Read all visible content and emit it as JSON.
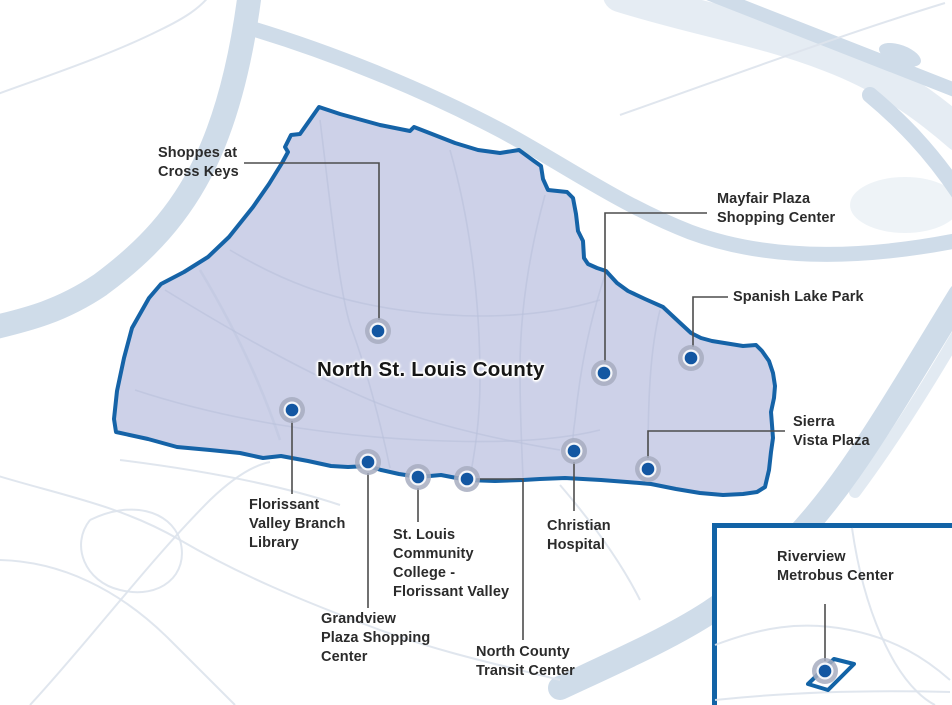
{
  "title": "North St. Louis County",
  "colors": {
    "region_fill": "#cdd1e8",
    "region_border": "#1563a7",
    "marker_dot": "#1357a2",
    "marker_halo": "#f4f6fa",
    "marker_ring": "#a7adc0",
    "leader_line": "#4d4d4d",
    "inset_border": "#1263a6",
    "river": "#cfdce9",
    "road": "#dde3ec",
    "label_text": "#2b2b2b"
  },
  "locations": [
    {
      "id": "shoppes-at-cross-keys",
      "lines": [
        "Shoppes at",
        "Cross Keys"
      ],
      "marker": {
        "x": 378,
        "y": 331
      },
      "leader": [
        [
          244,
          163
        ],
        [
          379,
          163
        ],
        [
          379,
          320
        ]
      ],
      "label": {
        "x": 158,
        "y": 144
      }
    },
    {
      "id": "mayfair-plaza-shopping-center",
      "lines": [
        "Mayfair Plaza",
        "Shopping Center"
      ],
      "marker": {
        "x": 604,
        "y": 373
      },
      "leader": [
        [
          707,
          213
        ],
        [
          605,
          213
        ],
        [
          605,
          362
        ]
      ],
      "label": {
        "x": 717,
        "y": 190
      }
    },
    {
      "id": "spanish-lake-park",
      "lines": [
        "Spanish Lake Park"
      ],
      "marker": {
        "x": 691,
        "y": 358
      },
      "leader": [
        [
          728,
          297
        ],
        [
          693,
          297
        ],
        [
          693,
          347
        ]
      ],
      "label": {
        "x": 733,
        "y": 288
      }
    },
    {
      "id": "sierra-vista-plaza",
      "lines": [
        "Sierra",
        "Vista Plaza"
      ],
      "marker": {
        "x": 648,
        "y": 469
      },
      "leader": [
        [
          785,
          431
        ],
        [
          648,
          431
        ],
        [
          648,
          458
        ]
      ],
      "label": {
        "x": 793,
        "y": 413
      }
    },
    {
      "id": "florissant-valley-branch-library",
      "lines": [
        "Florissant",
        "Valley Branch",
        "Library"
      ],
      "marker": {
        "x": 292,
        "y": 410
      },
      "leader": [
        [
          292,
          421
        ],
        [
          292,
          494
        ]
      ],
      "label": {
        "x": 249,
        "y": 496
      }
    },
    {
      "id": "st-louis-community-college-florissant-valley",
      "lines": [
        "St. Louis",
        "Community",
        "College -",
        "Florissant Valley"
      ],
      "marker": {
        "x": 418,
        "y": 477
      },
      "leader": [
        [
          418,
          488
        ],
        [
          418,
          522
        ]
      ],
      "label": {
        "x": 393,
        "y": 526
      }
    },
    {
      "id": "grandview-plaza-shopping-center",
      "lines": [
        "Grandview",
        "Plaza Shopping",
        "Center"
      ],
      "marker": {
        "x": 368,
        "y": 462
      },
      "leader": [
        [
          368,
          473
        ],
        [
          368,
          608
        ]
      ],
      "label": {
        "x": 321,
        "y": 610
      }
    },
    {
      "id": "christian-hospital",
      "lines": [
        "Christian",
        "Hospital"
      ],
      "marker": {
        "x": 574,
        "y": 451
      },
      "leader": [
        [
          574,
          462
        ],
        [
          574,
          511
        ]
      ],
      "label": {
        "x": 547,
        "y": 517
      }
    },
    {
      "id": "north-county-transit-center",
      "lines": [
        "North County",
        "Transit Center"
      ],
      "marker": {
        "x": 467,
        "y": 479
      },
      "leader": [
        [
          477,
          479
        ],
        [
          523,
          479
        ],
        [
          523,
          640
        ]
      ],
      "label": {
        "x": 476,
        "y": 643
      }
    },
    {
      "id": "riverview-metrobus-center",
      "lines": [
        "Riverview",
        "Metrobus Center"
      ],
      "marker": {
        "x": 825,
        "y": 671
      },
      "leader": [
        [
          825,
          604
        ],
        [
          825,
          661
        ]
      ],
      "label": {
        "x": 777,
        "y": 548
      }
    }
  ]
}
